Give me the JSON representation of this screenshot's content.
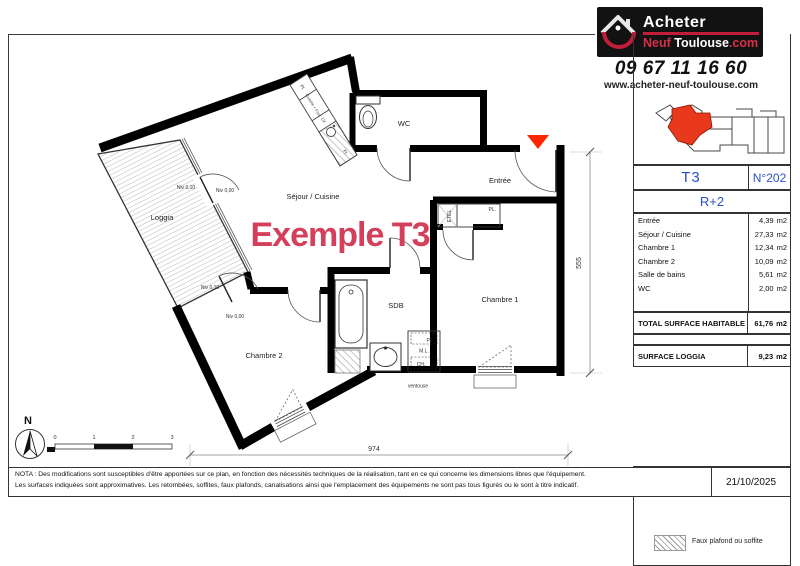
{
  "brand": {
    "line1": "Acheter",
    "neuf": "Neuf",
    "city": "Toulouse",
    "tld": ".com",
    "phone": "09 67 11 16 60",
    "website": "www.acheter-neuf-toulouse.com"
  },
  "title_block": {
    "type": "T3",
    "number": "N°202",
    "floor": "R+2",
    "rooms": [
      {
        "label": "Entrée",
        "value": "4,39",
        "unit": "m2"
      },
      {
        "label": "Séjour / Cuisine",
        "value": "27,33",
        "unit": "m2"
      },
      {
        "label": "Chambre 1",
        "value": "12,34",
        "unit": "m2"
      },
      {
        "label": "Chambre 2",
        "value": "10,09",
        "unit": "m2"
      },
      {
        "label": "Salle de bains",
        "value": "5,61",
        "unit": "m2"
      },
      {
        "label": "WC",
        "value": "2,00",
        "unit": "m2"
      }
    ],
    "total": {
      "label": "TOTAL SURFACE HABITABLE",
      "value": "61,76",
      "unit": "m2"
    },
    "loggia": {
      "label": "SURFACE LOGGIA",
      "value": "9,23",
      "unit": "m2"
    },
    "legend": "Faux plafond ou soffite",
    "date": "21/10/2025"
  },
  "plan": {
    "watermark": "Exemple T3",
    "rooms": {
      "loggia": "Loggia",
      "sejour": "Séjour / Cuisine",
      "entree": "Entrée",
      "wc": "WC",
      "chambre1": "Chambre 1",
      "chambre2": "Chambre 2",
      "sdb": "SDB"
    },
    "labels": {
      "etel": "ETEL",
      "pl_entree": "PL.",
      "pl_sdb": "PL.",
      "ml": "M.L.",
      "ch": "CH.",
      "ventouse": "ventouse",
      "niv010": "Niv 0,10",
      "niv000": "Niv 0,00",
      "kitchen_pl": "Pl.",
      "kitchen_four": "Cuisine + Four",
      "kitchen_lv": "LV",
      "kitchen_fr": "Fr."
    },
    "dimensions": {
      "width": "974",
      "height": "555"
    },
    "scale": [
      "0",
      "1",
      "2",
      "3"
    ],
    "north": "N"
  },
  "nota": {
    "line1": "NOTA : Des modifications sont susceptibles d'être apportées sur ce plan, en fonction des nécessités techniques de la réalisation, tant en ce qui concerne les dimensions libres que l'équipement.",
    "line2": "Les surfaces indiquées sont approximatives. Les retombées, soffites, faux plafonds, canalisations ainsi que l'emplacement des équipements ne sont pas tous figurés ou le sont à titre indicatif."
  },
  "colors": {
    "watermark": "#d4405c",
    "entrance_marker": "#ff2600",
    "accent_blue": "#2b50c8",
    "brand_red": "#c41d3c",
    "minimap_unit": "#e8391d"
  }
}
